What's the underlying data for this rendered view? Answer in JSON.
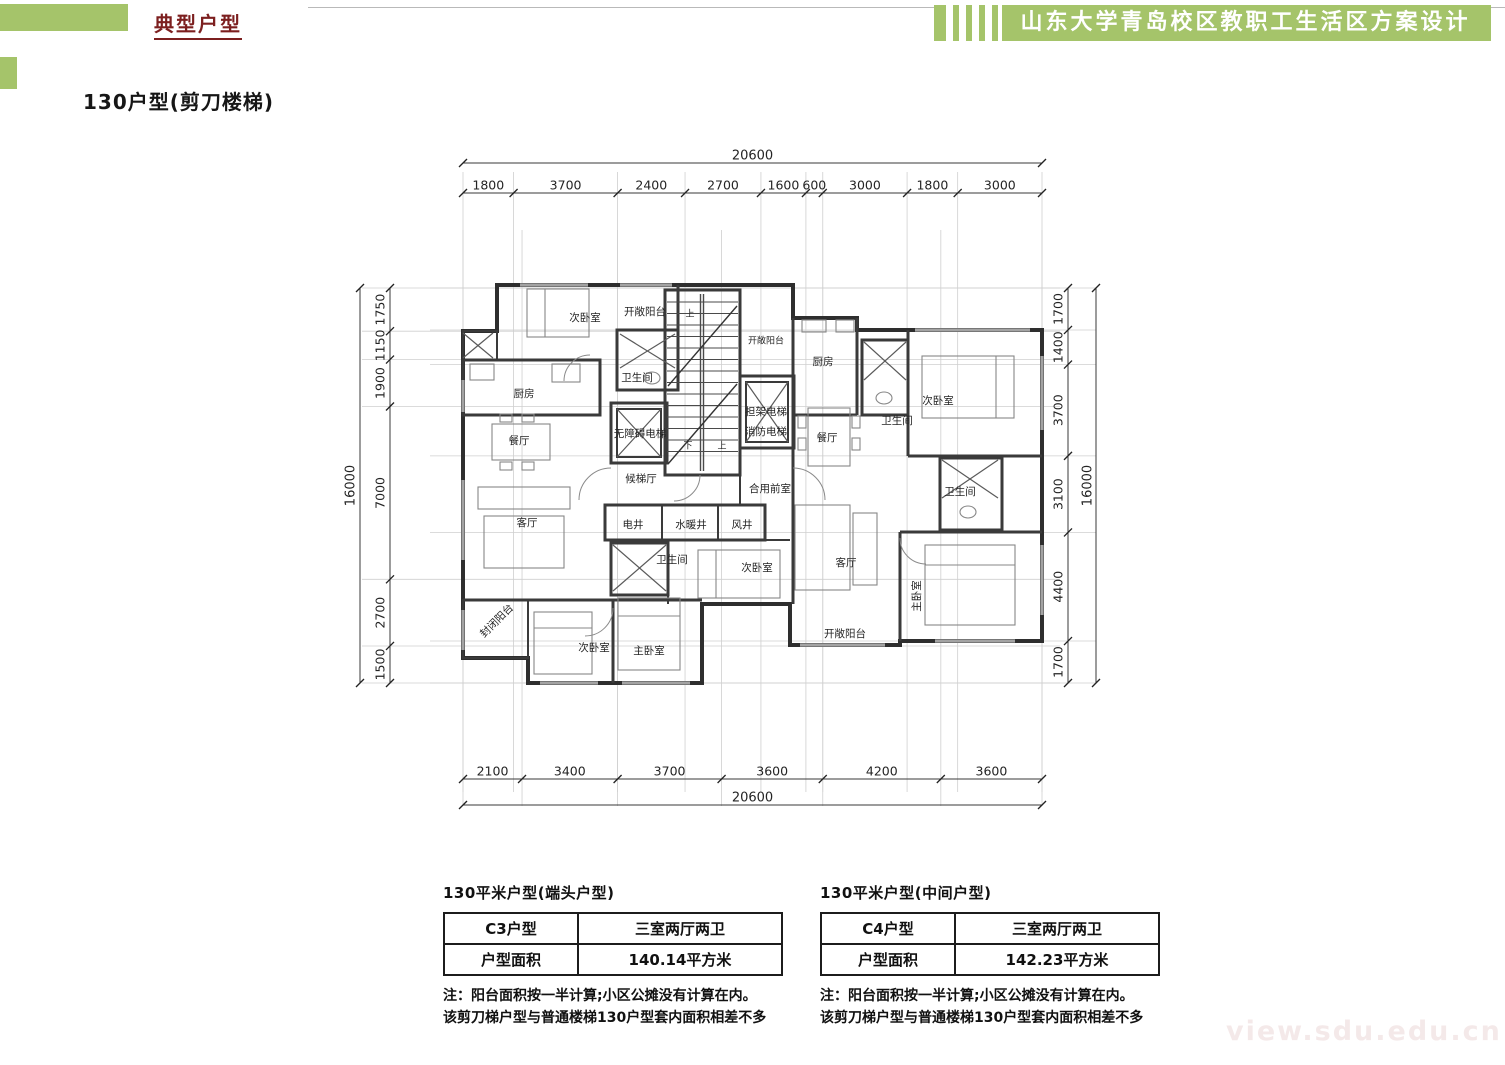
{
  "header": {
    "section_label": "典型户型",
    "project_title": "山东大学青岛校区教职工生活区方案设计",
    "accent_color": "#a5c46a",
    "section_label_color": "#7c1f1f"
  },
  "page_title": "130户型(剪刀楼梯)",
  "plan": {
    "dim_top_total": "20600",
    "dim_top": [
      "1800",
      "3700",
      "2400",
      "2700",
      "1600",
      "600",
      "3000",
      "1800",
      "3000"
    ],
    "dim_bottom": [
      "2100",
      "3400",
      "3700",
      "3600",
      "4200",
      "3600"
    ],
    "dim_bottom_total": "20600",
    "dim_left_total": "16000",
    "dim_left": [
      "1750",
      "1150",
      "1900",
      "7000",
      "2700",
      "1500"
    ],
    "dim_right": [
      "1700",
      "1400",
      "3700",
      "3100",
      "4400",
      "1700"
    ],
    "dim_right_total": "16000",
    "rooms": [
      {
        "label": "次卧室",
        "x": 585,
        "y": 318
      },
      {
        "label": "开敞阳台",
        "x": 645,
        "y": 312
      },
      {
        "label": "卫生间",
        "x": 637,
        "y": 378
      },
      {
        "label": "厨房",
        "x": 524,
        "y": 394
      },
      {
        "label": "餐厅",
        "x": 519,
        "y": 441
      },
      {
        "label": "客厅",
        "x": 527,
        "y": 523
      },
      {
        "label": "封闭阳台",
        "x": 497,
        "y": 621,
        "rot": -45
      },
      {
        "label": "次卧室",
        "x": 594,
        "y": 648
      },
      {
        "label": "主卧室",
        "x": 649,
        "y": 651
      },
      {
        "label": "无障碍电梯",
        "x": 640,
        "y": 434
      },
      {
        "label": "候梯厅",
        "x": 641,
        "y": 479
      },
      {
        "label": "电井",
        "x": 633,
        "y": 525
      },
      {
        "label": "水暖井",
        "x": 691,
        "y": 525
      },
      {
        "label": "风井",
        "x": 742,
        "y": 525
      },
      {
        "label": "卫生间",
        "x": 672,
        "y": 560
      },
      {
        "label": "上",
        "x": 690,
        "y": 314,
        "small": true
      },
      {
        "label": "下",
        "x": 688,
        "y": 446,
        "small": true
      },
      {
        "label": "上",
        "x": 722,
        "y": 446,
        "small": true
      },
      {
        "label": "开敞阳台",
        "x": 766,
        "y": 341,
        "small": true
      },
      {
        "label": "担架电梯",
        "x": 766,
        "y": 412
      },
      {
        "label": "消防电梯",
        "x": 766,
        "y": 432
      },
      {
        "label": "合用前室",
        "x": 770,
        "y": 489
      },
      {
        "label": "次卧室",
        "x": 757,
        "y": 568
      },
      {
        "label": "厨房",
        "x": 823,
        "y": 362
      },
      {
        "label": "餐厅",
        "x": 827,
        "y": 438
      },
      {
        "label": "卫生间",
        "x": 897,
        "y": 421
      },
      {
        "label": "次卧室",
        "x": 938,
        "y": 401
      },
      {
        "label": "卫生间",
        "x": 960,
        "y": 492
      },
      {
        "label": "客厅",
        "x": 846,
        "y": 563
      },
      {
        "label": "开敞阳台",
        "x": 845,
        "y": 634
      },
      {
        "label": "主卧室",
        "x": 917,
        "y": 596,
        "rot": -90
      }
    ]
  },
  "cards": [
    {
      "heading": "130平米户型(端头户型)",
      "rows": [
        {
          "k": "C3户型",
          "v": "三室两厅两卫"
        },
        {
          "k": "户型面积",
          "v": "140.14平方米"
        }
      ],
      "note1": "注：阳台面积按一半计算;小区公摊没有计算在内。",
      "note2": "该剪刀梯户型与普通楼梯130户型套内面积相差不多"
    },
    {
      "heading": "130平米户型(中间户型)",
      "rows": [
        {
          "k": "C4户型",
          "v": "三室两厅两卫"
        },
        {
          "k": "户型面积",
          "v": "142.23平方米"
        }
      ],
      "note1": "注：阳台面积按一半计算;小区公摊没有计算在内。",
      "note2": "该剪刀梯户型与普通楼梯130户型套内面积相差不多"
    }
  ],
  "watermark": "view.sdu.edu.cn"
}
